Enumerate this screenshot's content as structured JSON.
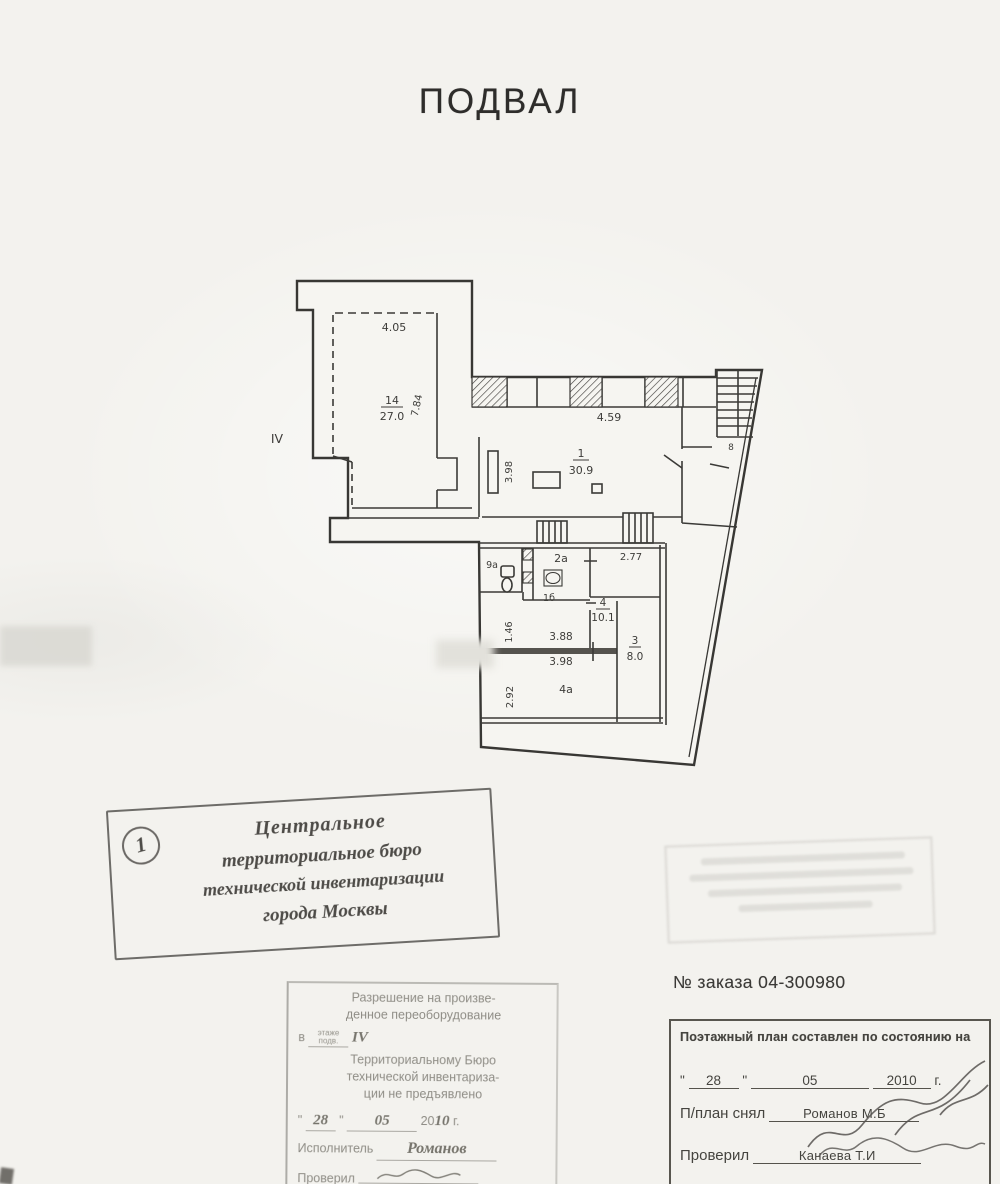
{
  "title": "ПОДВАЛ",
  "plan": {
    "floor_label": "IV",
    "rooms": {
      "room14": {
        "number": "14",
        "area": "27.0"
      },
      "room1": {
        "number": "1",
        "area": "30.9"
      },
      "room4": {
        "number": "4",
        "area": "10.1"
      },
      "room3": {
        "number": "3",
        "area": "8.0"
      },
      "room4a": "4а",
      "room2a": "2а",
      "room9a": "9а",
      "room1b": "1б",
      "stair_room": "8"
    },
    "dimensions": {
      "top_left_width": "4.05",
      "room14_height": "7.84",
      "room1_width": "4.59",
      "pier_height": "3.98",
      "room4_width": "2.77",
      "corridor_width_upper": "3.88",
      "corridor_width_lower": "3.98",
      "corridor_height": "1.46",
      "room4a_height": "2.92"
    }
  },
  "bureau_stamp": {
    "number": "1",
    "lines": [
      "Центральное",
      "территориальное бюро",
      "технической инвентаризации",
      "города Москвы"
    ]
  },
  "order_number": "№ заказа 04-300980",
  "date_table": {
    "header": "Поэтажный план составлен по состоянию на",
    "quote_mark": "\"",
    "day": "28",
    "month": "05",
    "year": "2010",
    "year_suffix": "г.",
    "surveyed_label": "П/план снял",
    "surveyed_by": "Романов М.Б",
    "checked_label": "Проверил",
    "checked_by": "Канаева Т.И"
  },
  "permission_stamp": {
    "line1": "Разрешение на произве-",
    "line2": "денное переоборудование",
    "prefix": "в",
    "floor_word_top": "этаже",
    "floor_word_bottom": "подв.",
    "floor_value": "IV",
    "line4": "Территориальному Бюро",
    "line5": "технической инвентариза-",
    "line6": "ции не предъявлено",
    "quote_mark": "\"",
    "day": "28",
    "month": "05",
    "century": "20",
    "year": "10",
    "year_suffix": "г.",
    "executor_label": "Исполнитель",
    "executor_value": "Романов",
    "checked_label": "Проверил"
  }
}
